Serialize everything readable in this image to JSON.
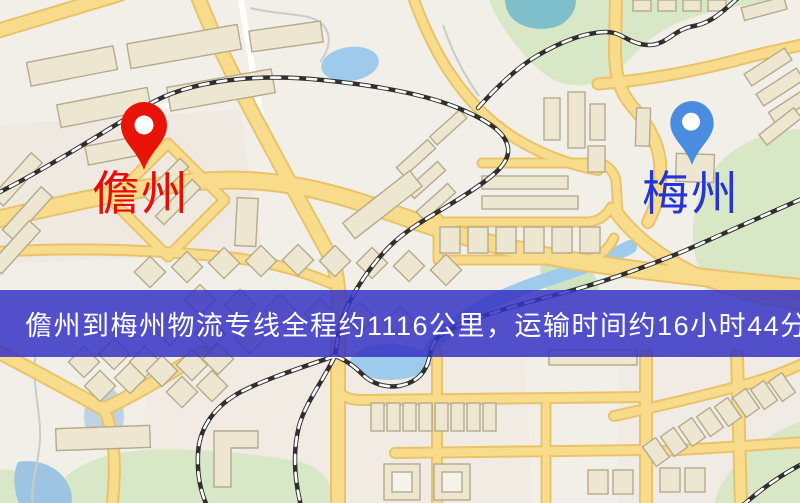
{
  "banner": {
    "text": "儋州到梅州物流专线全程约1116公里，运输时间约16小时44分钟.",
    "background_color": "#3632c4",
    "text_color": "#ffffff"
  },
  "map": {
    "markers": [
      {
        "name": "儋州",
        "pin_color": "#ea1309",
        "label_color": "#e60d06",
        "pin_style": "red-teardrop"
      },
      {
        "name": "梅州",
        "pin_color": "#4a8ce0",
        "label_color": "#2434d8",
        "pin_style": "blue-teardrop"
      }
    ],
    "style_colors": {
      "background": "#f2efe9",
      "road_fill": "#f8dc8c",
      "road_casing": "#e9c369",
      "building": "#ede6d0",
      "building_outline": "#b5aa8e",
      "park": "#d8e7c6",
      "water": "#9ecbec",
      "railway": "#2f2f2f"
    }
  }
}
